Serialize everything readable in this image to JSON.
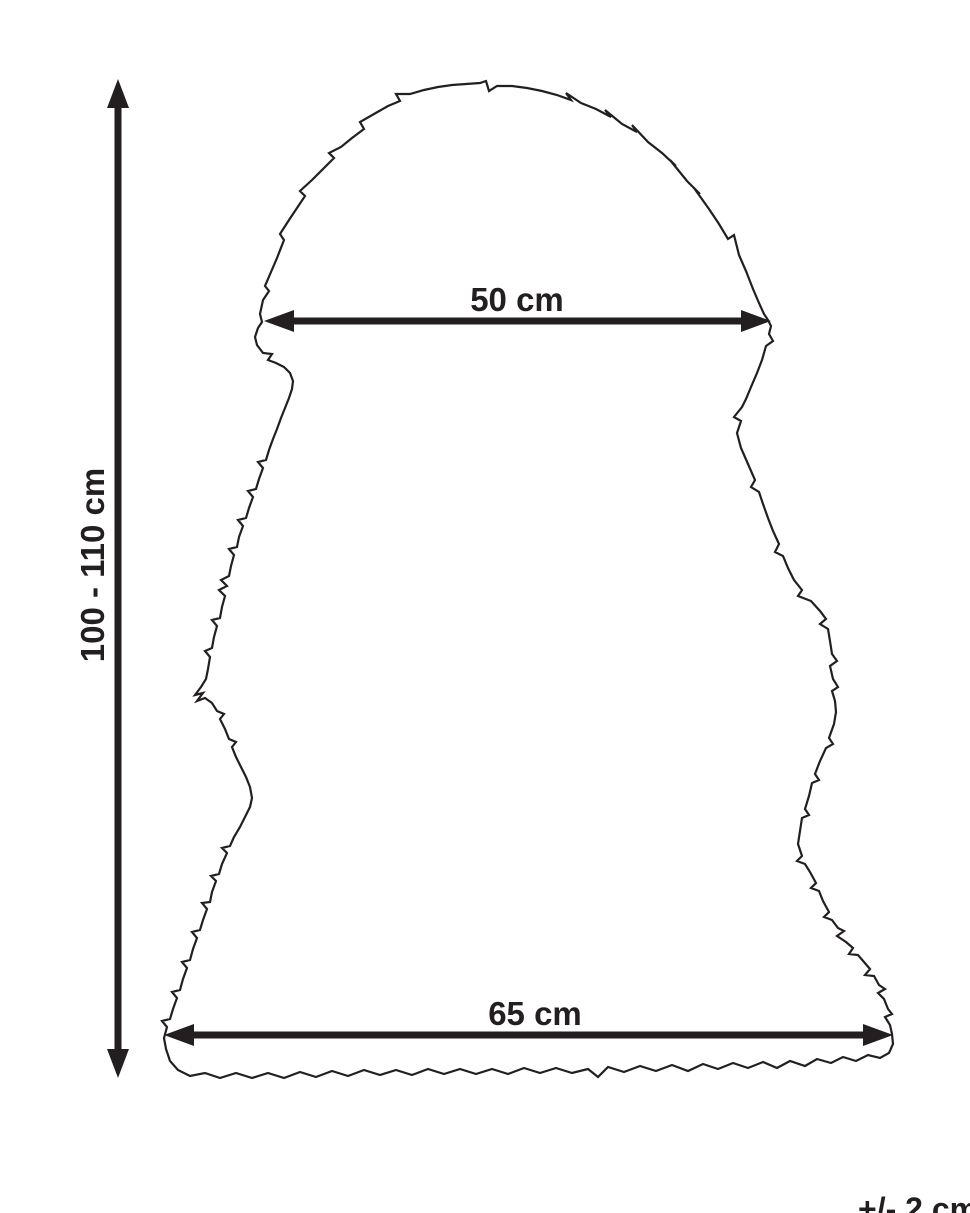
{
  "page": {
    "background_color": "#ffffff"
  },
  "diagram": {
    "subject": "sheepskin-rug-dimension-outline",
    "line_color": "#231f20",
    "labels": {
      "height": "100 - 110 cm",
      "top_width": "50 cm",
      "bottom_width": "65 cm",
      "tolerance": "+/- 2 cm"
    },
    "measurements": {
      "height_cm": "100 - 110",
      "top_width_cm": "50",
      "bottom_width_cm": "65",
      "tolerance_cm": "+/- 2"
    }
  }
}
